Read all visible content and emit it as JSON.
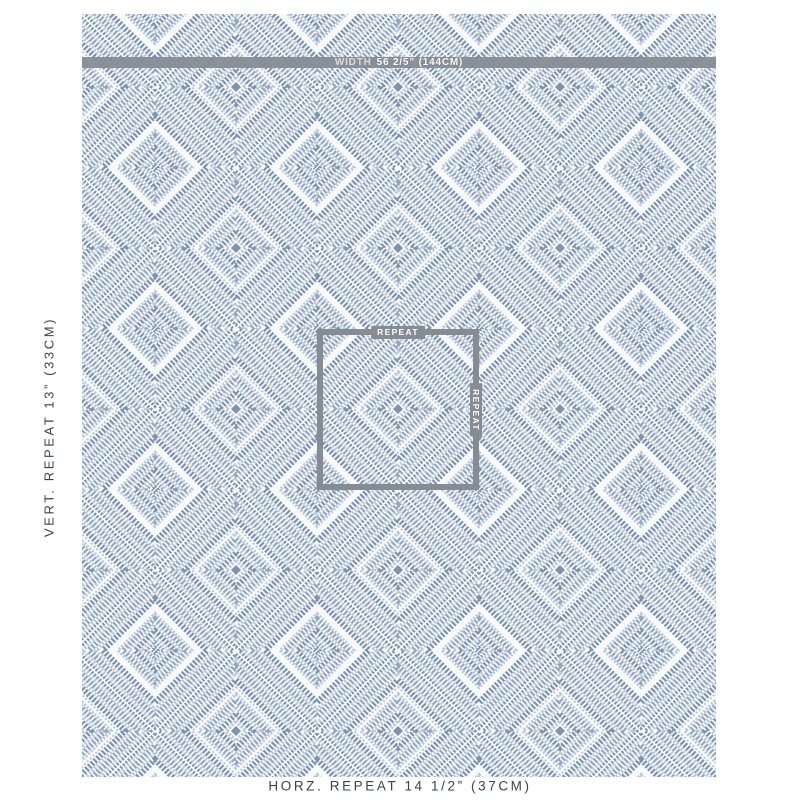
{
  "fabric": {
    "width_bar": {
      "label": "WIDTH",
      "value": "56 2/5” (144CM)"
    },
    "repeat_box": {
      "top_label": "REPEAT",
      "side_label": "REPEAT"
    }
  },
  "labels": {
    "vertical_repeat": "VERT. REPEAT 13” (33CM)",
    "horizontal_repeat": "HORZ. REPEAT 14 1/2” (37CM)"
  },
  "pattern": {
    "description": "woven diamond-in-diamond geometric fabric, concentric hatched rhombus bands",
    "repeat_px": {
      "horizontal": 162,
      "vertical": 161
    }
  },
  "colors": {
    "overlay_gray": "#868c93",
    "label_text": "#3b424a",
    "fabric_background": "#f8f9f9",
    "pattern_blue_dark": "#7e93af",
    "pattern_blue_mid": "#93a7c0",
    "pattern_blue_light": "#bac8d8"
  }
}
